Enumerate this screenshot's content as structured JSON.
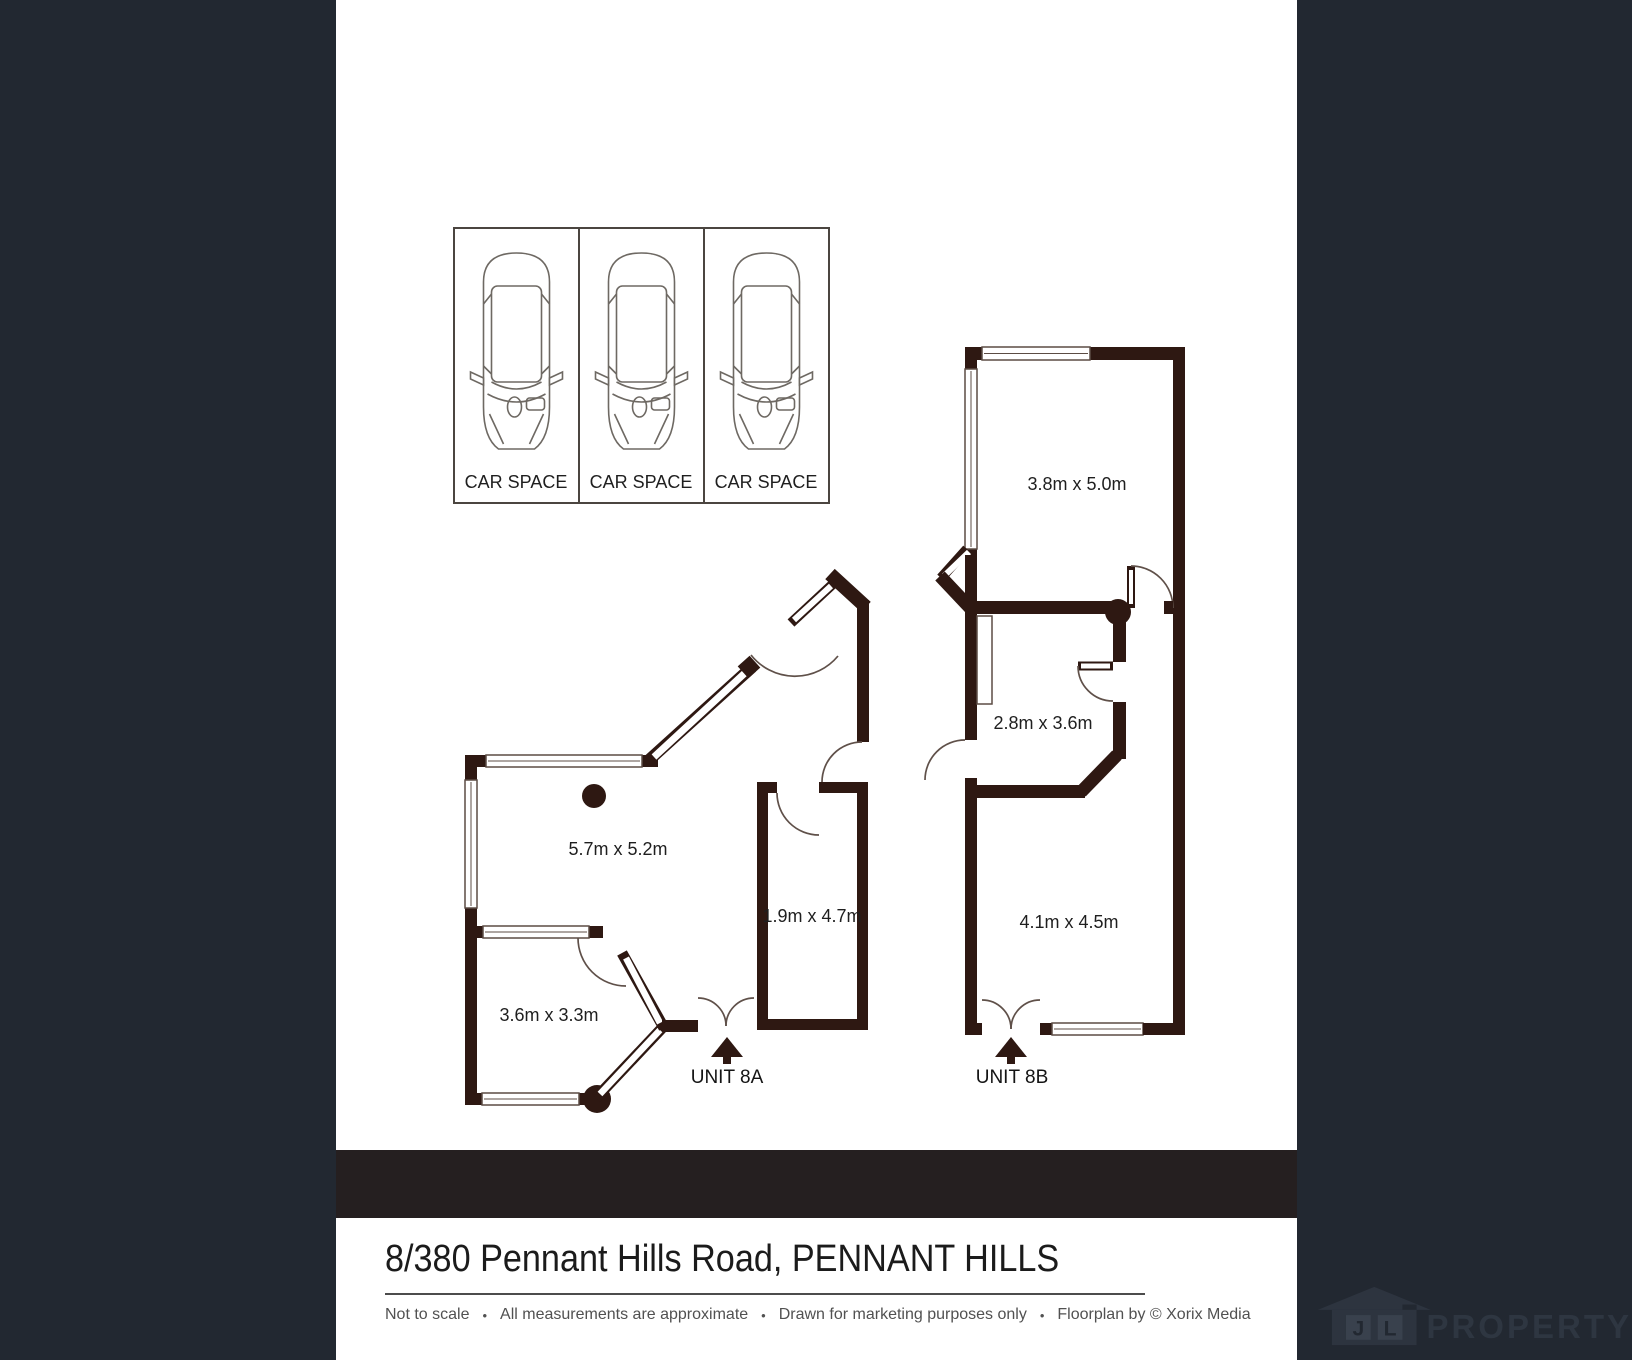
{
  "colors": {
    "sidebar": "#222831",
    "divider_band": "#251f20",
    "wall": "#2e1812",
    "body_text": "#1b1b1b",
    "muted_text": "#515151",
    "logo_text": "#2e3641"
  },
  "carpark": {
    "spaces": [
      {
        "label": "CAR SPACE"
      },
      {
        "label": "CAR SPACE"
      },
      {
        "label": "CAR SPACE"
      }
    ]
  },
  "units": {
    "unit_a": {
      "name": "UNIT 8A",
      "rooms": {
        "room1": "5.7m x 5.2m",
        "room2": "1.9m x 4.7m",
        "room3": "3.6m x 3.3m"
      }
    },
    "unit_b": {
      "name": "UNIT 8B",
      "rooms": {
        "room1": "3.8m x 5.0m",
        "room2": "2.8m x 3.6m",
        "room3": "4.1m x 4.5m"
      }
    }
  },
  "footer": {
    "address": "8/380 Pennant Hills Road, PENNANT HILLS",
    "disclaimer": [
      "Not to scale",
      "All measurements are approximate",
      "Drawn for marketing purposes only",
      "Floorplan by © Xorix Media"
    ],
    "separator": "•"
  },
  "logo": {
    "letter_j": "J",
    "letter_l": "L",
    "name": "PROPERTY"
  }
}
